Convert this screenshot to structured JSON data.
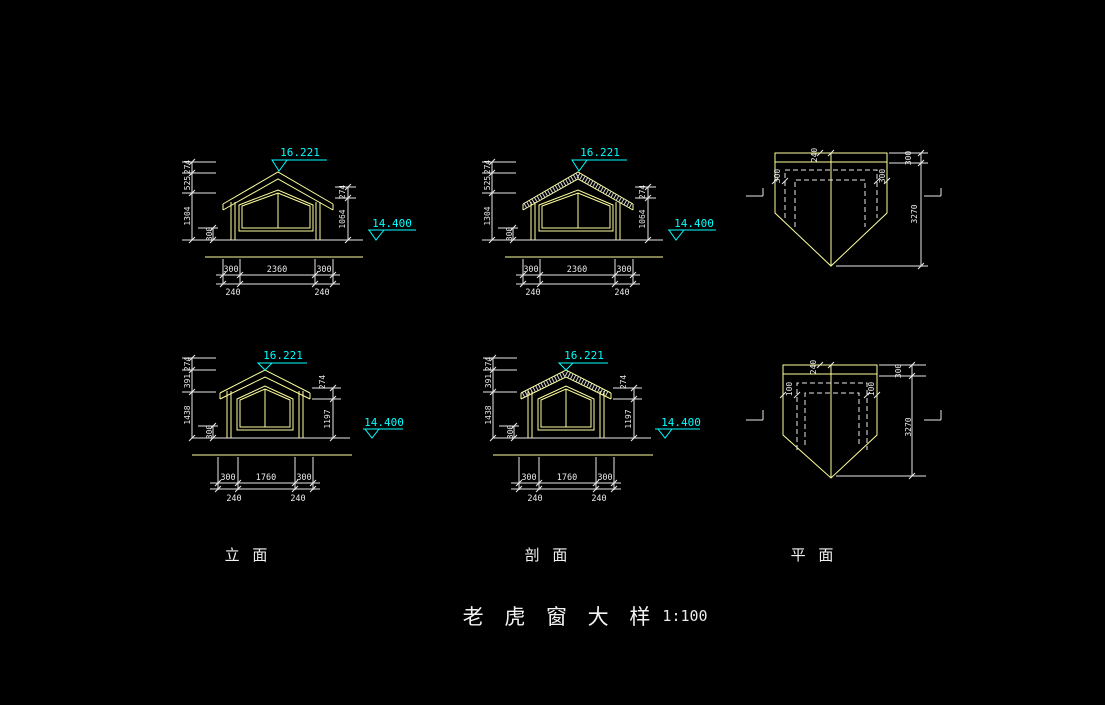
{
  "title": {
    "name": "老 虎 窗 大 样",
    "scale": "1:100"
  },
  "labels": {
    "elevation": "立 面",
    "section": "剖 面",
    "plan": "平 面"
  },
  "colors": {
    "background": "#000000",
    "building_lines": "#FFFF9E",
    "dimension_lines": "#E9E9E9",
    "level_markers": "#00FFFF"
  },
  "elev_top": {
    "level_ridge": "16.221",
    "level_eave": "14.400",
    "dim_ridge": "274",
    "dim_upper": "525",
    "dim_wall": "1304",
    "dim_sill": "300",
    "dim_eave": "274",
    "dim_height": "1064",
    "dim_left": "300",
    "dim_width": "2360",
    "dim_right": "300",
    "dim_overhang_left": "240",
    "dim_overhang_right": "240"
  },
  "sect_top": {
    "level_ridge": "16.221",
    "level_eave": "14.400",
    "dim_ridge": "274",
    "dim_upper": "525",
    "dim_wall": "1304",
    "dim_sill": "300",
    "dim_eave": "274",
    "dim_height": "1064",
    "dim_left": "300",
    "dim_width": "2360",
    "dim_right": "300",
    "dim_overhang_left": "240",
    "dim_overhang_right": "240"
  },
  "plan_top": {
    "dim_ridge_offset": "240",
    "dim_side_left": "300",
    "dim_side_right": "300",
    "dim_top": "300",
    "dim_depth": "3270"
  },
  "elev_bot": {
    "level_ridge": "16.221",
    "level_eave": "14.400",
    "dim_ridge": "274",
    "dim_upper": "391",
    "dim_wall": "1438",
    "dim_sill": "300",
    "dim_eave": "274",
    "dim_height": "1197",
    "dim_left": "300",
    "dim_width": "1760",
    "dim_right": "300",
    "dim_overhang_left": "240",
    "dim_overhang_right": "240"
  },
  "sect_bot": {
    "level_ridge": "16.221",
    "level_eave": "14.400",
    "dim_ridge": "274",
    "dim_upper": "391",
    "dim_wall": "1438",
    "dim_sill": "300",
    "dim_eave": "274",
    "dim_height": "1197",
    "dim_left": "300",
    "dim_width": "1760",
    "dim_right": "300",
    "dim_overhang_left": "240",
    "dim_overhang_right": "240"
  },
  "plan_bot": {
    "dim_ridge_offset": "240",
    "dim_side_left": "100",
    "dim_side_right": "100",
    "dim_top": "300",
    "dim_depth": "3270"
  }
}
